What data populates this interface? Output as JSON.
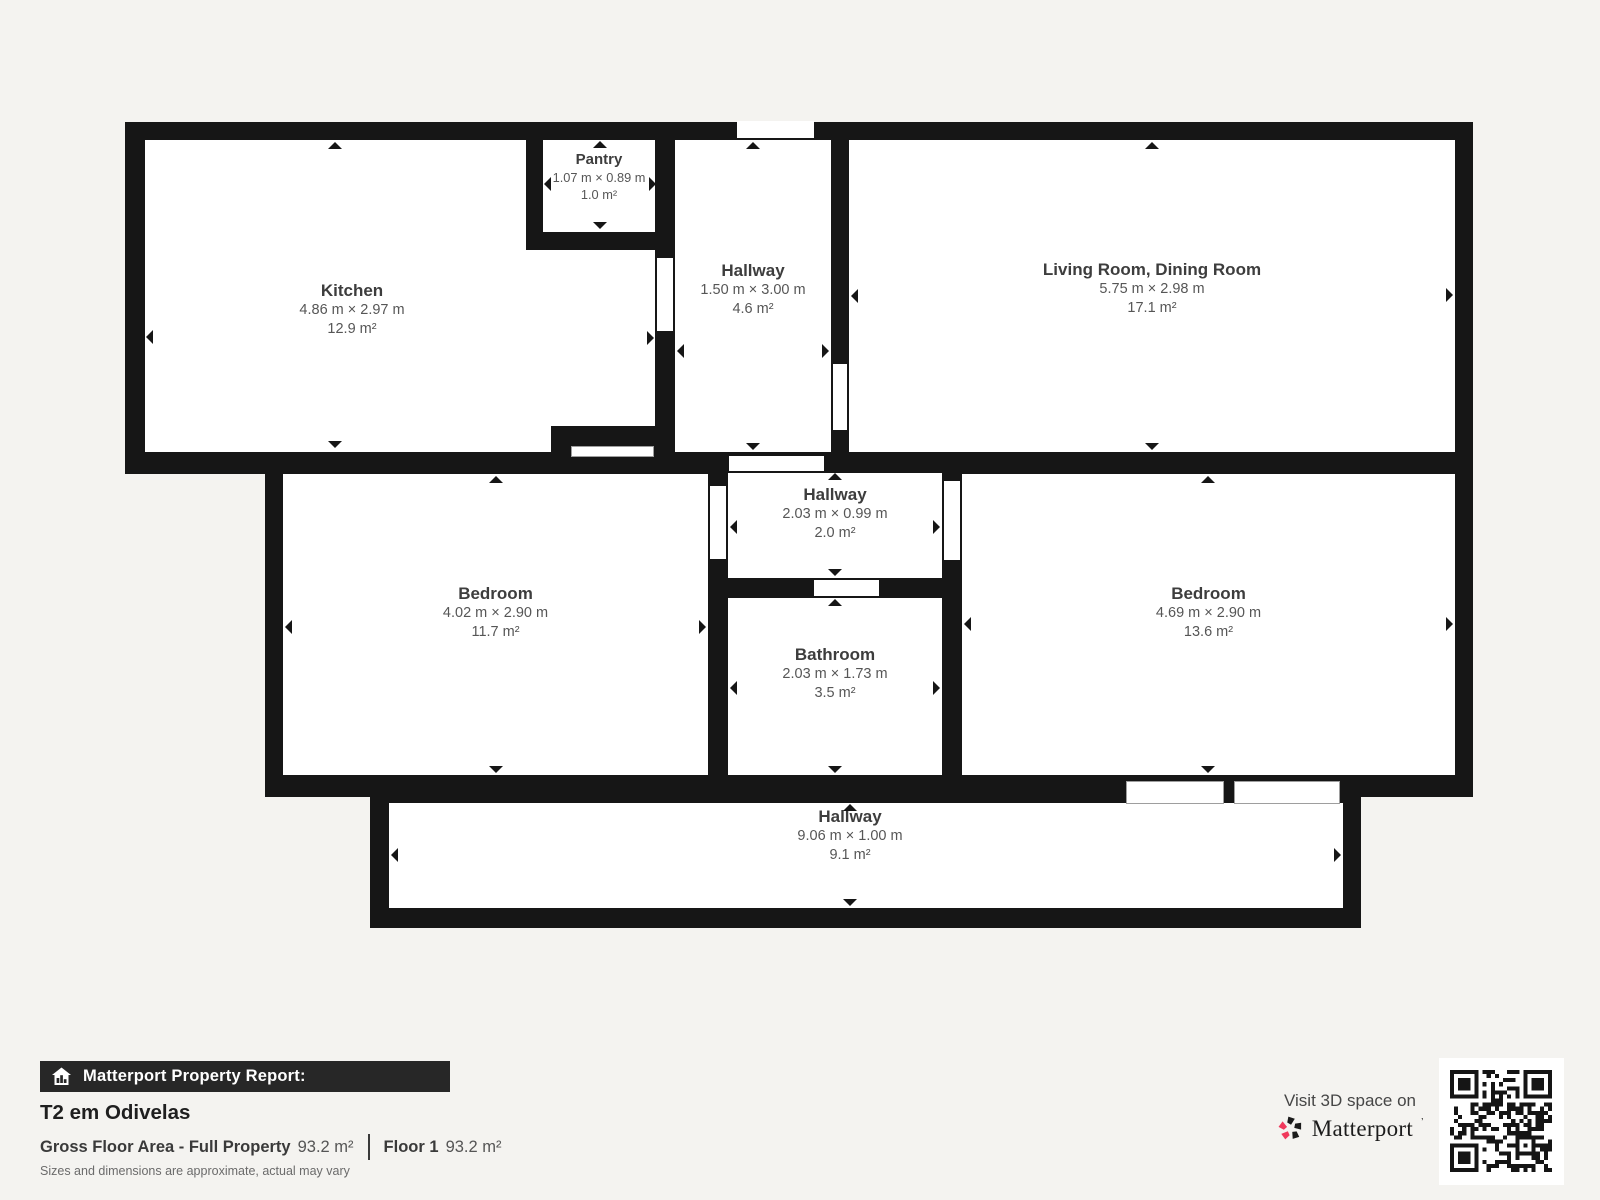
{
  "rooms": [
    {
      "id": "pantry",
      "name": "Pantry",
      "dims": "1.07 m × 0.89 m",
      "area": "1.0 m²"
    },
    {
      "id": "kitchen",
      "name": "Kitchen",
      "dims": "4.86 m × 2.97 m",
      "area": "12.9 m²"
    },
    {
      "id": "hallway-top",
      "name": "Hallway",
      "dims": "1.50 m × 3.00 m",
      "area": "4.6 m²"
    },
    {
      "id": "living-dining",
      "name": "Living Room, Dining Room",
      "dims": "5.75 m × 2.98 m",
      "area": "17.1 m²"
    },
    {
      "id": "hallway-middle",
      "name": "Hallway",
      "dims": "2.03 m × 0.99 m",
      "area": "2.0 m²"
    },
    {
      "id": "bedroom-left",
      "name": "Bedroom",
      "dims": "4.02 m × 2.90 m",
      "area": "11.7 m²"
    },
    {
      "id": "bathroom",
      "name": "Bathroom",
      "dims": "2.03 m × 1.73 m",
      "area": "3.5 m²"
    },
    {
      "id": "bedroom-right",
      "name": "Bedroom",
      "dims": "4.69 m × 2.90 m",
      "area": "13.6 m²"
    },
    {
      "id": "hallway-bottom",
      "name": "Hallway",
      "dims": "9.06 m × 1.00 m",
      "area": "9.1 m²"
    }
  ],
  "footer": {
    "report_label": "Matterport Property Report:",
    "property_title": "T2 em Odivelas",
    "gross_label": "Gross Floor Area - Full Property",
    "gross_value": "93.2 m²",
    "floor_label": "Floor 1",
    "floor_value": "93.2 m²",
    "disclaimer": "Sizes and dimensions are approximate, actual may vary",
    "visit_text": "Visit 3D space on",
    "brand": "Matterport",
    "brand_tm": "’"
  },
  "colors": {
    "background": "#f4f3f0",
    "wall": "#161616",
    "room": "#ffffff",
    "accent_pink": "#f0395c",
    "label_text": "#3d3d3d",
    "dims_text": "#565656"
  }
}
